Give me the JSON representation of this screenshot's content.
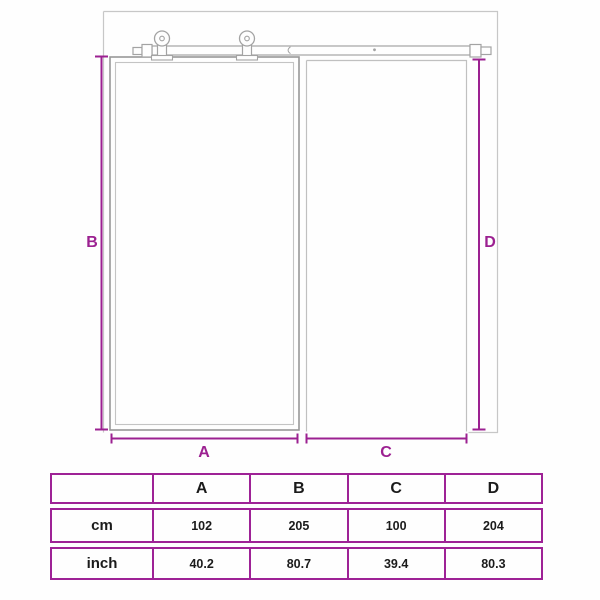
{
  "page": {
    "description": "Product dimension diagram of a sliding barn door with top rail rollers, plus a size table",
    "background_color": "#fefefe"
  },
  "diagram": {
    "dimension_labels": {
      "A": "A",
      "B": "B",
      "C": "C",
      "D": "D"
    },
    "parts": [
      "wall-outline",
      "left-door-panel",
      "doorway-opening",
      "sliding-rail",
      "left-roller",
      "right-roller"
    ]
  },
  "dimensions_table": {
    "corner": "",
    "columns": [
      "A",
      "B",
      "C",
      "D"
    ],
    "rows": [
      {
        "unit": "cm",
        "values": [
          "102",
          "205",
          "100",
          "204"
        ]
      },
      {
        "unit": "inch",
        "values": [
          "40.2",
          "80.7",
          "39.4",
          "80.3"
        ]
      }
    ]
  },
  "chart_data": {
    "type": "table",
    "title": "Sliding door dimensions",
    "categories": [
      "A",
      "B",
      "C",
      "D"
    ],
    "series": [
      {
        "name": "cm",
        "values": [
          102,
          205,
          100,
          204
        ]
      },
      {
        "name": "inch",
        "values": [
          40.2,
          80.7,
          39.4,
          80.3
        ]
      }
    ]
  },
  "colors": {
    "accent_magenta": "#9c2191",
    "table_border": "#9e2296",
    "line_gray": "#c7c7c7",
    "door_gray": "#989898",
    "text_black": "#1b1b1b"
  }
}
